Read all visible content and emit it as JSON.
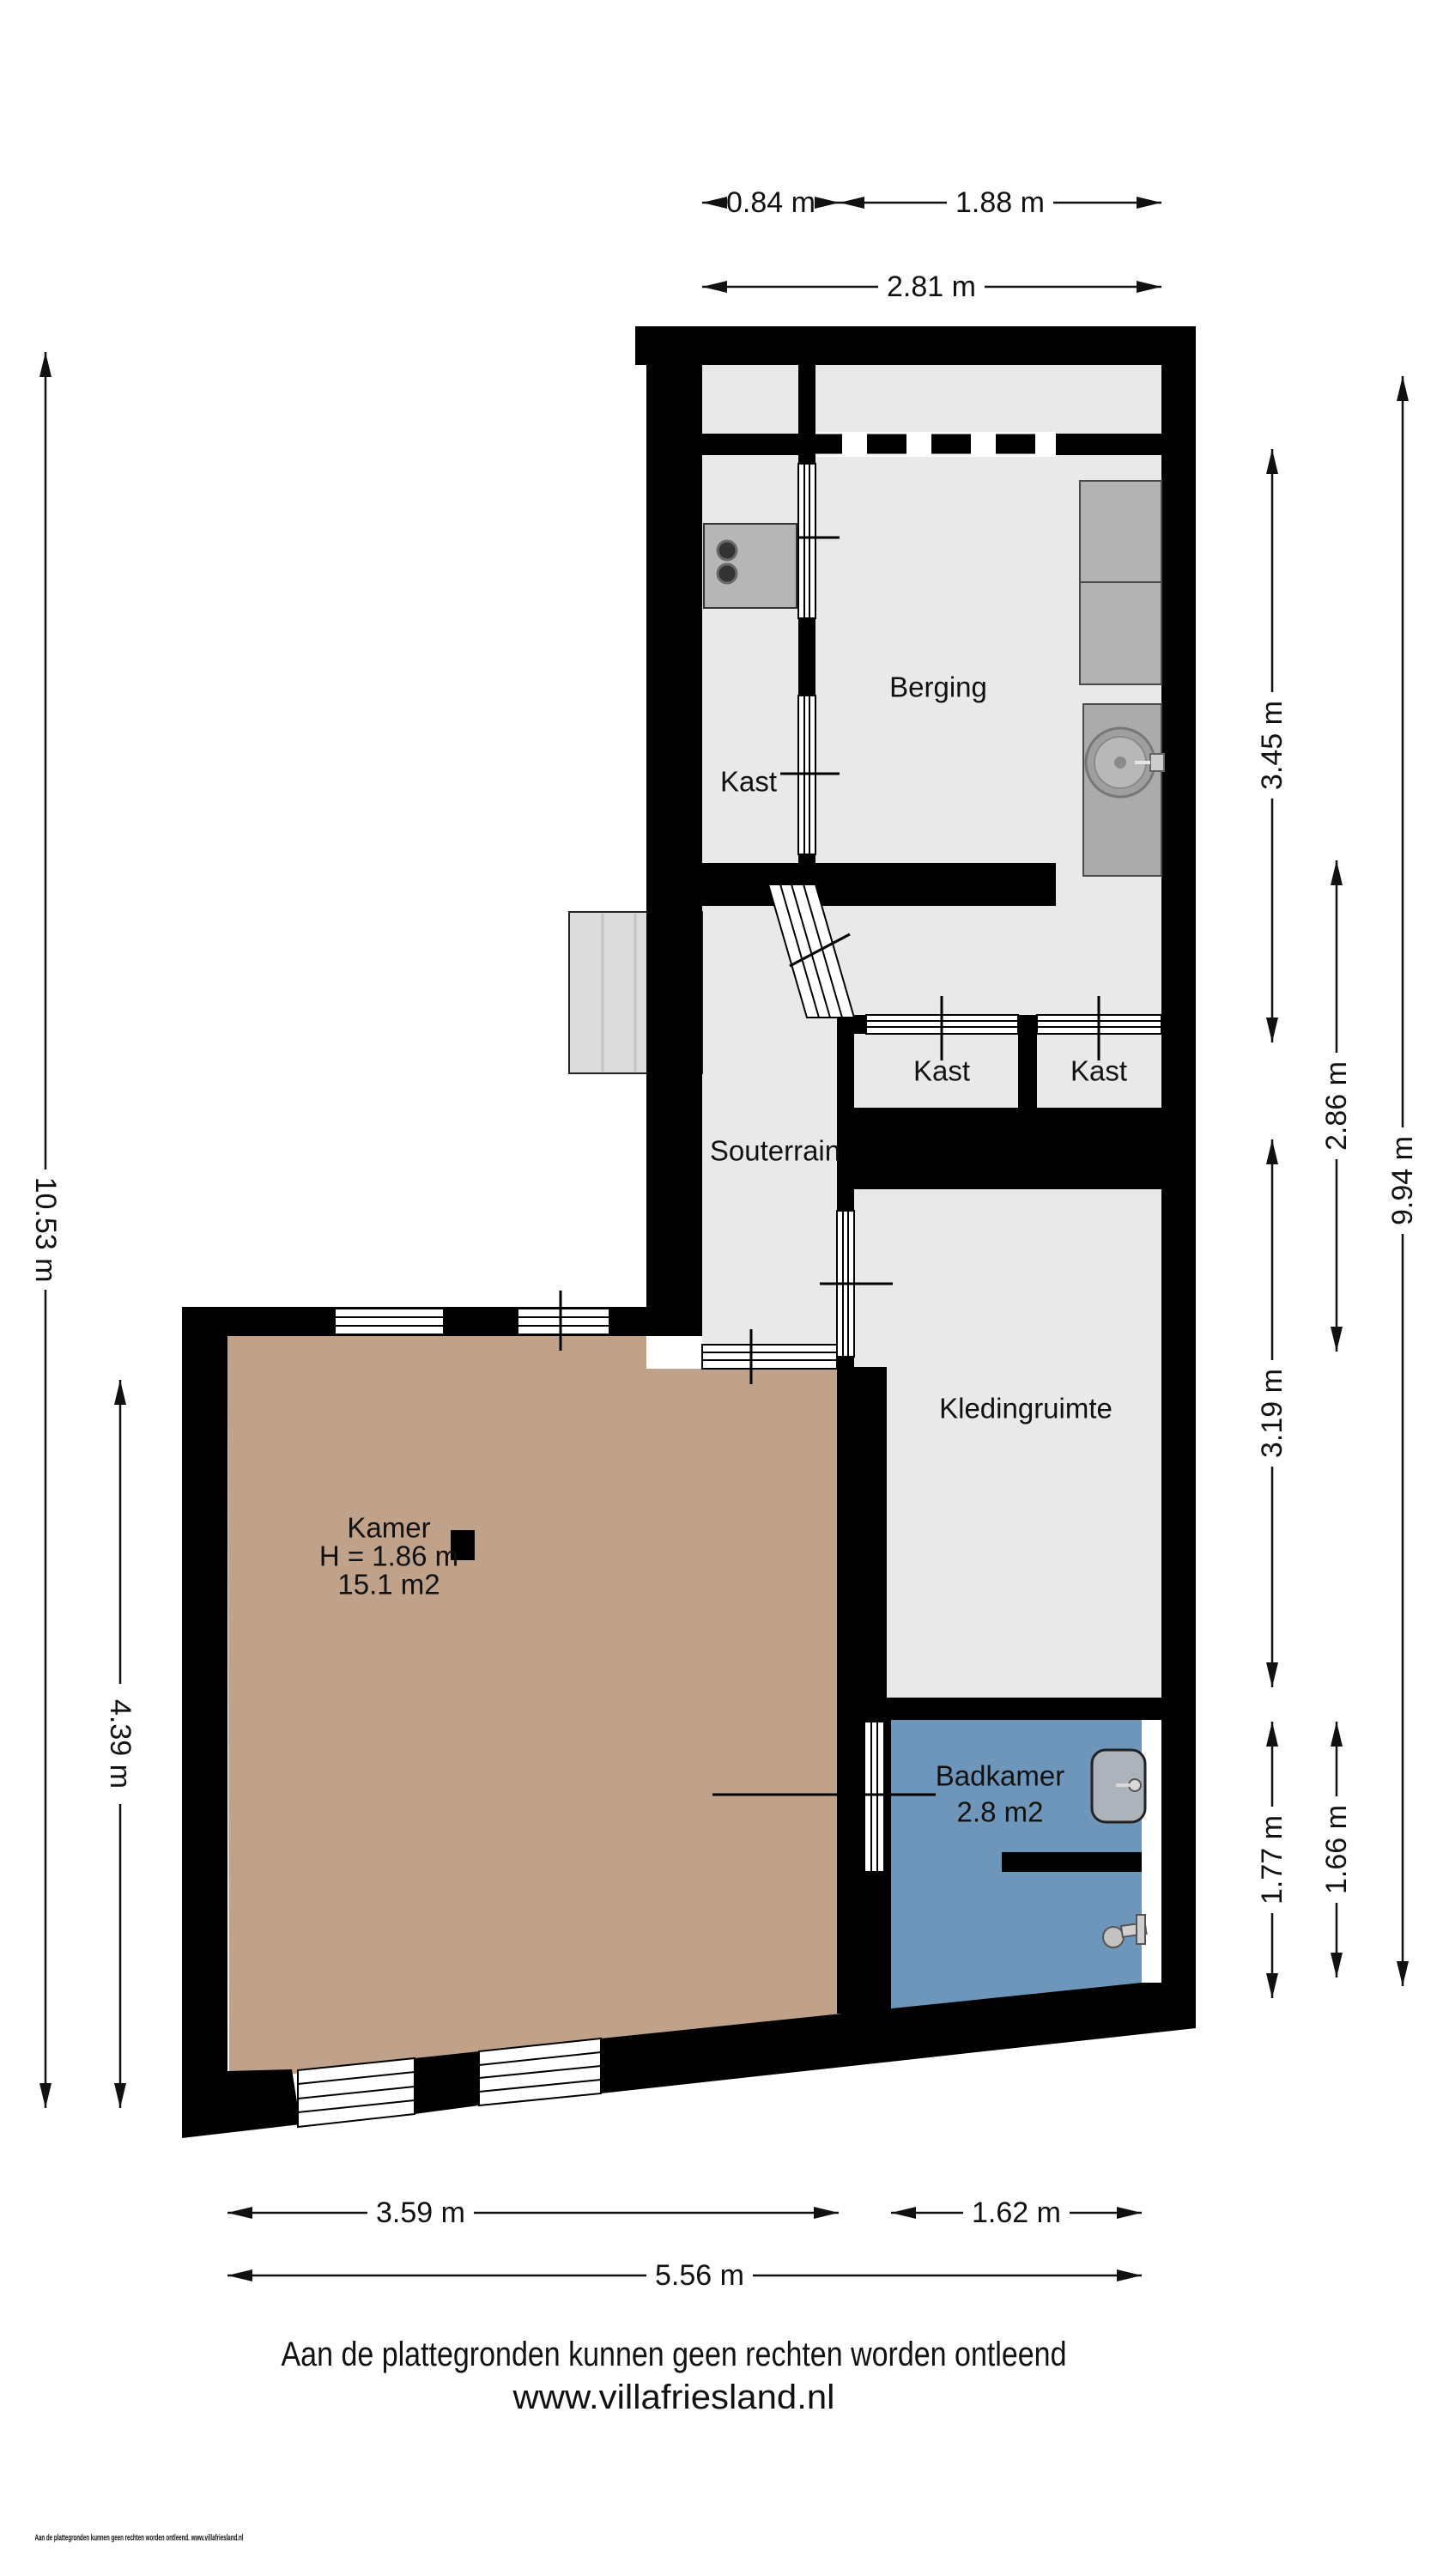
{
  "plan_title": "Souterrain floor plan",
  "rooms": {
    "berging": {
      "label": "Berging"
    },
    "kast_left": {
      "label": "Kast"
    },
    "kast_mid": {
      "label": "Kast"
    },
    "kast_right": {
      "label": "Kast"
    },
    "souterrain": {
      "label": "Souterrain"
    },
    "kledingruimte": {
      "label": "Kledingruimte"
    },
    "kamer": {
      "label": "Kamer",
      "ceiling_height": "H = 1.86 m",
      "area": "15.1 m2"
    },
    "badkamer": {
      "label": "Badkamer",
      "area": "2.8 m2"
    }
  },
  "dimensions": {
    "top_left_width": "0.84 m",
    "top_right_width": "1.88 m",
    "top_total_width": "2.81 m",
    "right_berging_height": "3.45 m",
    "right_middle_height": "2.86 m",
    "right_total_height": "9.94 m",
    "right_kleding_height": "3.19 m",
    "right_badkamer_height": "1.77 m",
    "right_badkamer_outer_height": "1.66 m",
    "left_total_height": "10.53 m",
    "left_kamer_height": "4.39 m",
    "bottom_kamer_width": "3.59 m",
    "bottom_badkamer_width": "1.62 m",
    "bottom_total_width": "5.56 m"
  },
  "footer": {
    "disclaimer": "Aan de plattegronden kunnen geen rechten worden ontleend",
    "website": "www.villafriesland.nl",
    "fine_print": "Aan de plattegronden kunnen geen rechten worden ontleend. www.villafriesland.nl"
  },
  "colors": {
    "wall": "#000000",
    "room_gray": "#e9e9e9",
    "kamer_tan": "#c0a189",
    "badkamer_blue": "#6e96ba",
    "furniture_gray": "#b3b3b3",
    "porch_gray": "#dcdcdc"
  }
}
